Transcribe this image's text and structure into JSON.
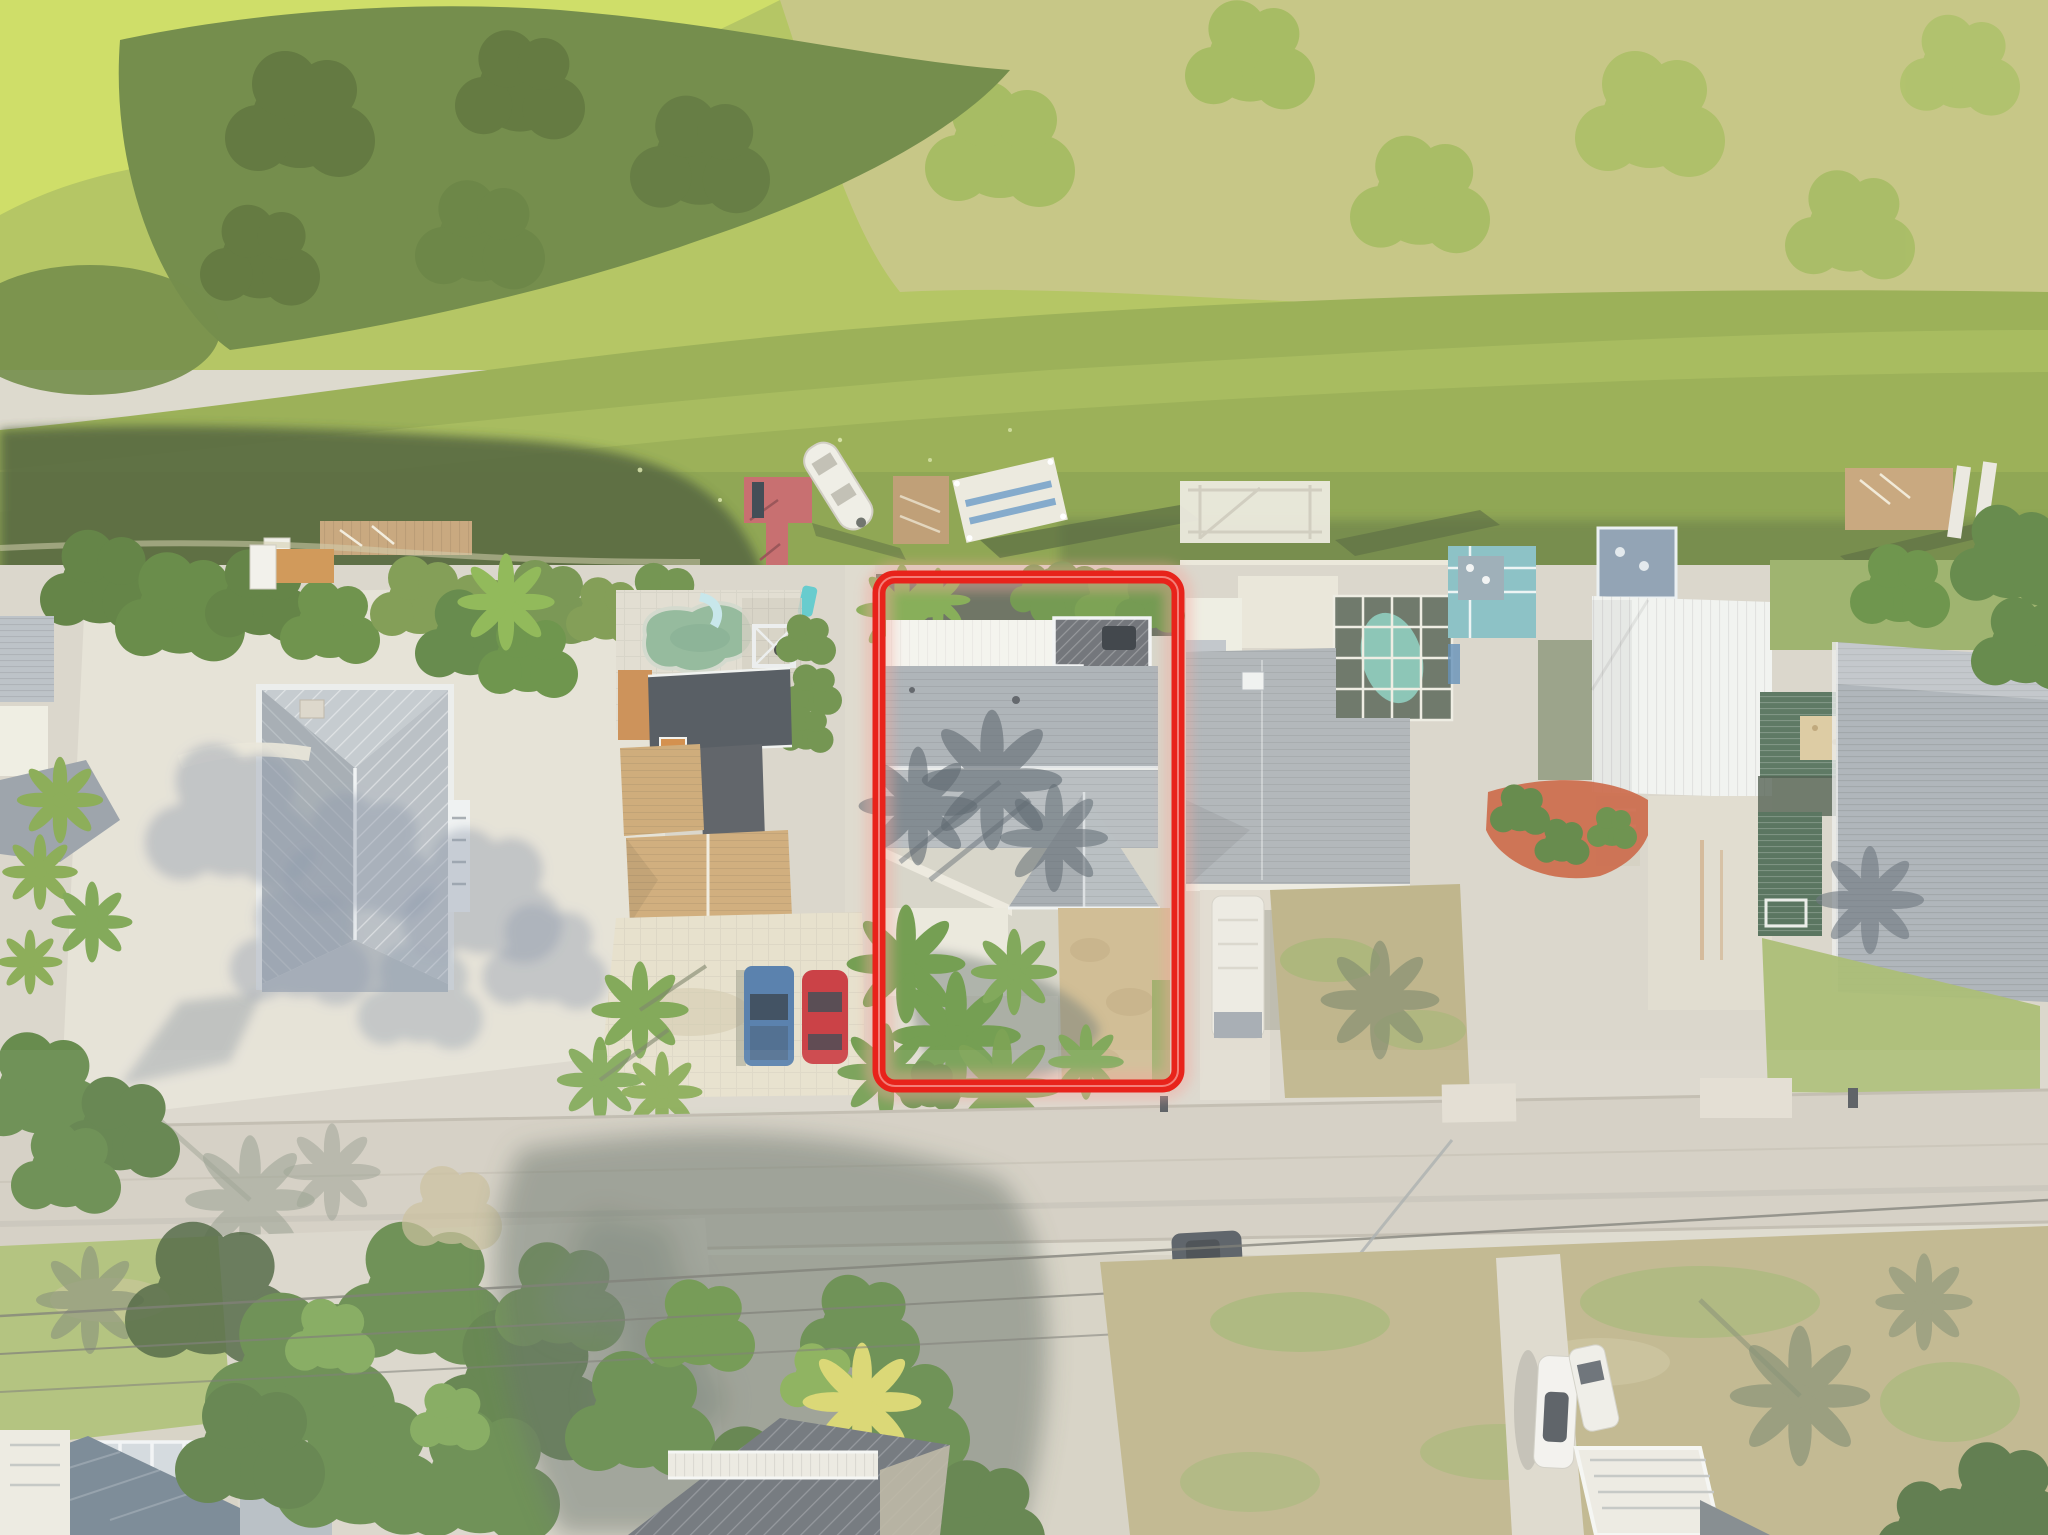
{
  "annotation": {
    "type": "property-boundary-highlight",
    "color": "#e8231b",
    "glow_color": "#f4a79d",
    "x": 879,
    "y": 577,
    "width": 299,
    "height": 509,
    "corner_radius": 16,
    "stroke_width": 13
  },
  "palette": {
    "haze": "#ffffff",
    "marsh_base": "#a8bd4a",
    "marsh_bright": "#c7d94f",
    "marsh_trees": "#5d7b2e",
    "marsh_trees_dark": "#465f1f",
    "marsh_dry": "#c6bf82",
    "water": "#8ba43d",
    "water_light": "#a3ba4b",
    "water_dark": "#6d8a33",
    "water_shadow": "#3c5121",
    "concrete": "#d5d1c3",
    "concrete_bright": "#e2ded1",
    "paver": "#e3dcc5",
    "road": "#cdc7b9",
    "road_seam": "#b7b0a2",
    "shadow_cool": "#76828f",
    "shadow_dark": "#47544a",
    "roof_metal": "#b2b9bf",
    "roof_metal_dark": "#99a2a9",
    "roof_white": "#f3f2ec",
    "roof_shingle": "#a2a8ad",
    "roof_shingle_light": "#aeb4b8",
    "roof_charcoal": "#3d434a",
    "roof_brown": "#c79f66",
    "wall_orange": "#c5803f",
    "deck_wood": "#5c6065",
    "pool_water": "#84b08e",
    "pool_slide": "#bfe3e8",
    "teal": "#4ec3c6",
    "dock_red": "#bf5759",
    "dock_wood": "#c09a6a",
    "dock_white": "#e9e7da",
    "boat_white": "#edebe2",
    "stripe_blue": "#5a8fc0",
    "lawn_green": "#9eb360",
    "lawn_brown": "#b5aa7a",
    "mulch": "#c4532e",
    "metal_white": "#eff1ee",
    "teal_wall": "#7ab8bd",
    "deck_blue": "#8095a8",
    "green_roof": "#43634a",
    "tree_green": "#4e7830",
    "tree_light": "#6d9a40",
    "palm_yellow": "#d3cf56",
    "car_blue": "#3f6da0",
    "car_red": "#c22127",
    "car_white": "#f1f0ea",
    "suv_dark": "#3a4148",
    "rv_white": "#eae8df",
    "wire": "#63635a"
  },
  "scene": {
    "environment": {
      "marsh": "dense green and dry marsh vegetation band along top edge",
      "canal": "canal with green algae-covered water and boat docks",
      "street": "light concrete residential street crossing the lower third",
      "exposure": "sun-washed hazy aerial drone photograph"
    },
    "docks": [
      "wood dock with utility trailer",
      "red T-shaped dock with moored white boat",
      "small wood dock with ladder",
      "white floating dock with blue bunks",
      "white boat-lift dock",
      "wood dock with boat lift at far right"
    ],
    "buildings": [
      {
        "name": "left-metal-roof-house",
        "roof": "gray standing-seam metal hip roof"
      },
      {
        "name": "pool-house",
        "feature": "kidney-shaped pool with green water, slide and pergola"
      },
      {
        "name": "brown-roof-house",
        "roof": "tan shingle gables, charcoal section, orange walls"
      },
      {
        "name": "highlighted-house",
        "roof": "gray shingle roof, white flat roof, rooftop wood deck",
        "yard": "palm landscaping with gravel drive"
      },
      {
        "name": "right-neighbor-house",
        "feature": "screened pool cage with teal pool, parked RV"
      },
      {
        "name": "teal-cottage",
        "color": "teal walls with white trim"
      },
      {
        "name": "white-metal-building",
        "roof": "white standing-seam metal"
      },
      {
        "name": "far-right-house",
        "roof": "gray corrugated metal with dark-green porch roofs"
      },
      {
        "name": "bottom-left-house",
        "roof": "blue-gray metal with skylight band"
      },
      {
        "name": "bottom-center-house",
        "roof": "charcoal metal roof with white deck railing"
      }
    ],
    "vehicles": [
      {
        "name": "pickup-truck",
        "color": "#3f6da0"
      },
      {
        "name": "sports-car",
        "color": "#c22127"
      },
      {
        "name": "suv",
        "color": "#3a4148"
      },
      {
        "name": "white-car-a",
        "color": "#f1f0ea"
      },
      {
        "name": "white-car-b",
        "color": "#eceae3"
      },
      {
        "name": "rv-trailer",
        "color": "#eae8df"
      },
      {
        "name": "utility-trailer",
        "color": "#efeee6"
      }
    ],
    "counts": {
      "docks": 6,
      "vehicles": 7,
      "palm_trees_in_highlighted_yard": 6
    }
  }
}
